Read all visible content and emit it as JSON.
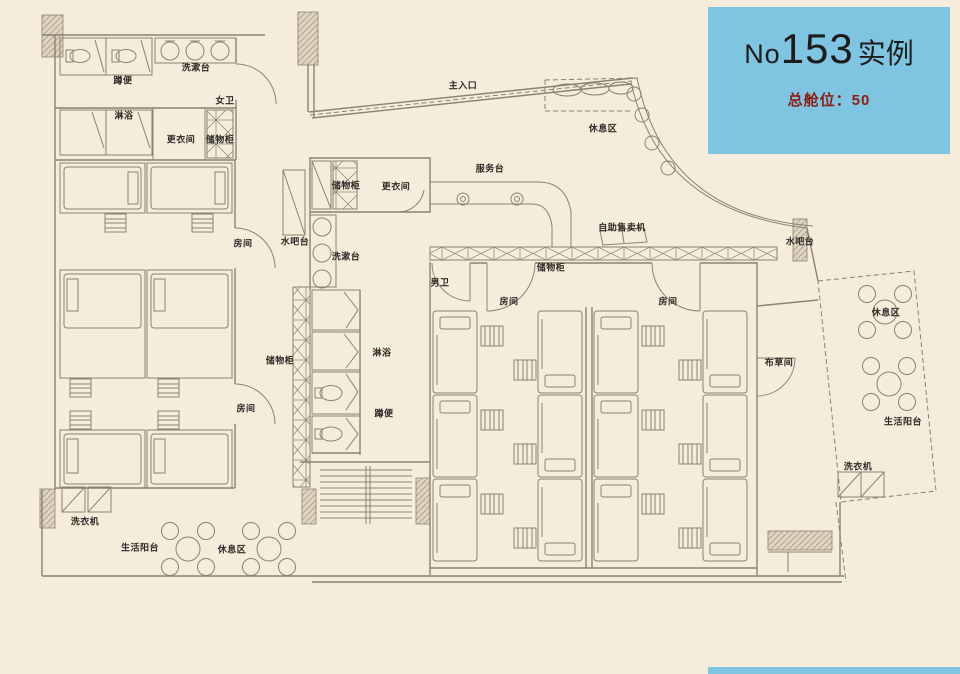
{
  "info_card": {
    "number_prefix": "No",
    "number": "153",
    "suffix": "实例",
    "capacity": "总舱位：50",
    "bg_color": "#7fc4e0",
    "capacity_color": "#8b1f14"
  },
  "plan": {
    "bg_color": "#f5ecdb",
    "line_color": "#8b8273",
    "labels": [
      {
        "id": "main-entrance",
        "text": "主入口",
        "x": 463,
        "y": 85
      },
      {
        "id": "wash-basin-top",
        "text": "洗漱台",
        "x": 196,
        "y": 67
      },
      {
        "id": "squat-toilet-top",
        "text": "蹲便",
        "x": 123,
        "y": 80
      },
      {
        "id": "womens-restroom",
        "text": "女卫",
        "x": 225,
        "y": 100
      },
      {
        "id": "shower-top",
        "text": "淋浴",
        "x": 124,
        "y": 115
      },
      {
        "id": "changing-room-left",
        "text": "更衣间",
        "x": 181,
        "y": 139
      },
      {
        "id": "locker-left",
        "text": "储物柜",
        "x": 220,
        "y": 139
      },
      {
        "id": "room-1",
        "text": "房间",
        "x": 243,
        "y": 243
      },
      {
        "id": "room-2",
        "text": "房间",
        "x": 246,
        "y": 408
      },
      {
        "id": "locker-mid",
        "text": "储物柜",
        "x": 280,
        "y": 360
      },
      {
        "id": "water-bar-left",
        "text": "水吧台",
        "x": 295,
        "y": 241
      },
      {
        "id": "locker-center",
        "text": "储物柜",
        "x": 346,
        "y": 185
      },
      {
        "id": "changing-room-center",
        "text": "更衣间",
        "x": 396,
        "y": 186
      },
      {
        "id": "wash-basin-center",
        "text": "洗漱台",
        "x": 346,
        "y": 256
      },
      {
        "id": "mens-restroom",
        "text": "男卫",
        "x": 440,
        "y": 282
      },
      {
        "id": "shower-center",
        "text": "淋浴",
        "x": 382,
        "y": 352
      },
      {
        "id": "squat-toilet-center",
        "text": "蹲便",
        "x": 384,
        "y": 413
      },
      {
        "id": "service-desk",
        "text": "服务台",
        "x": 490,
        "y": 168
      },
      {
        "id": "rest-area-top",
        "text": "休息区",
        "x": 603,
        "y": 128
      },
      {
        "id": "vending-machine",
        "text": "自助售卖机",
        "x": 622,
        "y": 227
      },
      {
        "id": "locker-row",
        "text": "储物柜",
        "x": 551,
        "y": 267
      },
      {
        "id": "room-3",
        "text": "房间",
        "x": 509,
        "y": 301
      },
      {
        "id": "room-4",
        "text": "房间",
        "x": 668,
        "y": 301
      },
      {
        "id": "water-bar-right",
        "text": "水吧台",
        "x": 800,
        "y": 241
      },
      {
        "id": "linen-room",
        "text": "布草间",
        "x": 779,
        "y": 362
      },
      {
        "id": "rest-area-right",
        "text": "休息区",
        "x": 886,
        "y": 312
      },
      {
        "id": "living-balcony-right",
        "text": "生活阳台",
        "x": 903,
        "y": 421
      },
      {
        "id": "washing-machine-right",
        "text": "洗衣机",
        "x": 858,
        "y": 466
      },
      {
        "id": "washing-machine-left",
        "text": "洗衣机",
        "x": 85,
        "y": 521
      },
      {
        "id": "living-balcony-left",
        "text": "生活阳台",
        "x": 140,
        "y": 547
      },
      {
        "id": "rest-area-bottom",
        "text": "休息区",
        "x": 232,
        "y": 549
      }
    ]
  }
}
